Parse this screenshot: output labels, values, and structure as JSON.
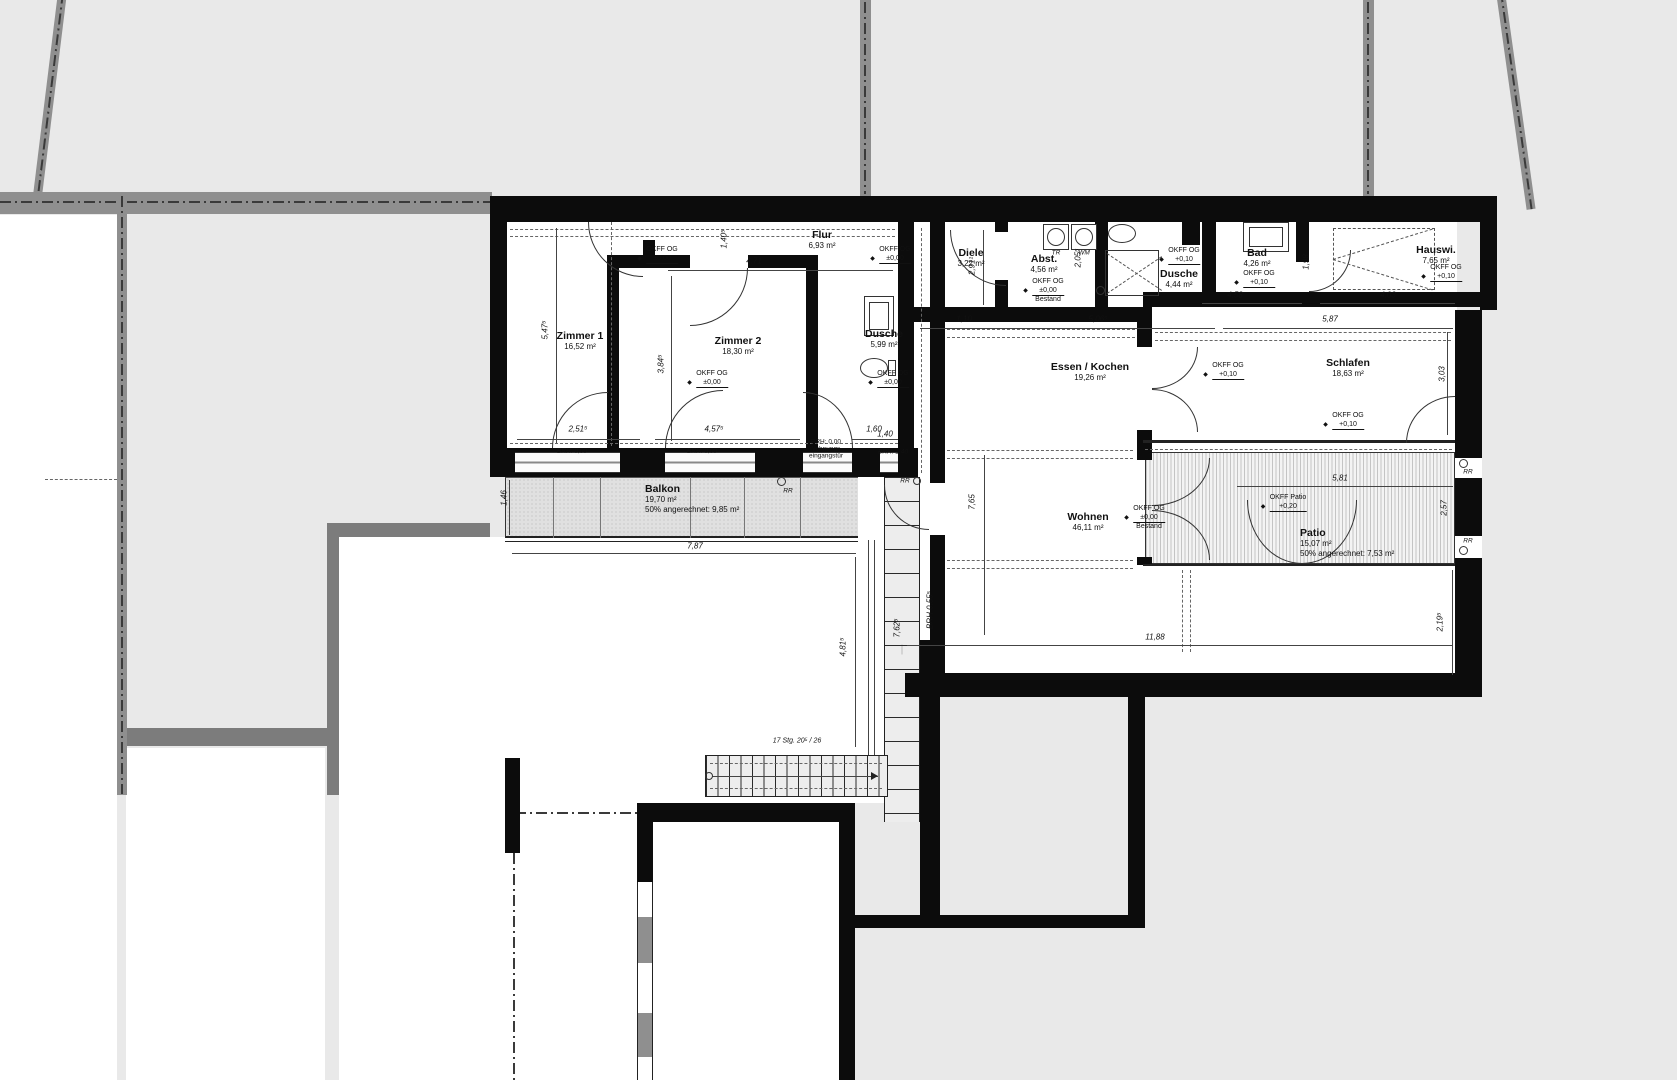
{
  "rooms": {
    "zimmer1": {
      "name": "Zimmer 1",
      "area": "16,52 m²"
    },
    "zimmer2": {
      "name": "Zimmer 2",
      "area": "18,30 m²"
    },
    "flur": {
      "name": "Flur",
      "area": "6,93 m²"
    },
    "dusche_links": {
      "name": "Dusche",
      "area": "5,99 m²"
    },
    "diele": {
      "name": "Diele",
      "area": "3,22 m²"
    },
    "abstellraum": {
      "name": "Abst.",
      "area": "4,56 m²"
    },
    "dusche_rechts": {
      "name": "Dusche",
      "area": "4,44 m²"
    },
    "bad": {
      "name": "Bad",
      "area": "4,26 m²"
    },
    "hauswirtschaft": {
      "name": "Hauswi.",
      "area": "7,65 m²"
    },
    "essen_kochen": {
      "name": "Essen / Kochen",
      "area": "19,26 m²"
    },
    "schlafen": {
      "name": "Schlafen",
      "area": "18,63 m²"
    },
    "wohnen": {
      "name": "Wohnen",
      "area": "46,11 m²"
    },
    "balkon": {
      "name": "Balkon",
      "area": "19,70 m²",
      "note": "50% angerechnet: 9,85 m²"
    },
    "patio": {
      "name": "Patio",
      "area": "15,07 m²",
      "note": "50% angerechnet: 7,53 m²"
    }
  },
  "levels": {
    "okff_og": "OKFF OG",
    "okff_patio": "OKFF Patio",
    "zero": "±0,00",
    "plus010": "+0,10",
    "plus020": "+0,20",
    "bestand": "Bestand"
  },
  "dims": {
    "flur_w": "4,71",
    "z1_h": "5,47⁵",
    "z1_w": "2,51⁵",
    "z2_w": "4,57⁵",
    "z2_h": "3,84⁵",
    "flur_d": "1,40⁵",
    "du_l": "1,60",
    "mid": "1,10",
    "abst_row": "5,06⁵",
    "diele_h": "2,91¹",
    "abst_h": "2,05⁵",
    "bad_w": "4,58",
    "bad_h": "1,98",
    "hauswi_w": "4,03",
    "schlafen_row": "5,87",
    "schlafen_h": "3,03",
    "patio_w": "5,81",
    "patio_h": "2,57",
    "wohnen_h": "7,65",
    "unit_w": "11,88",
    "right_h": "2,19⁵",
    "hof_w": "7,87",
    "hof_h": "4,81⁵",
    "balkon_d": "1,46",
    "gang_h": "7,62⁵",
    "gang_w": "1,40",
    "brh_mid": "BRH 0,55⁵"
  },
  "windows": {
    "brh000": "BRH: 0,00",
    "brh140": "BRH: 1,40",
    "entry_line1": "Wohnungs-",
    "entry_line2": "eingangstür"
  },
  "marks": {
    "rr": "RR",
    "tr": "TR",
    "wm": "WM"
  },
  "stairs": {
    "label": "17 Stg. 20⁵ / 26"
  },
  "colors": {
    "wall": "#0c0c0c",
    "site_band": "#8f8f8f",
    "background": "#e9e9e9"
  }
}
